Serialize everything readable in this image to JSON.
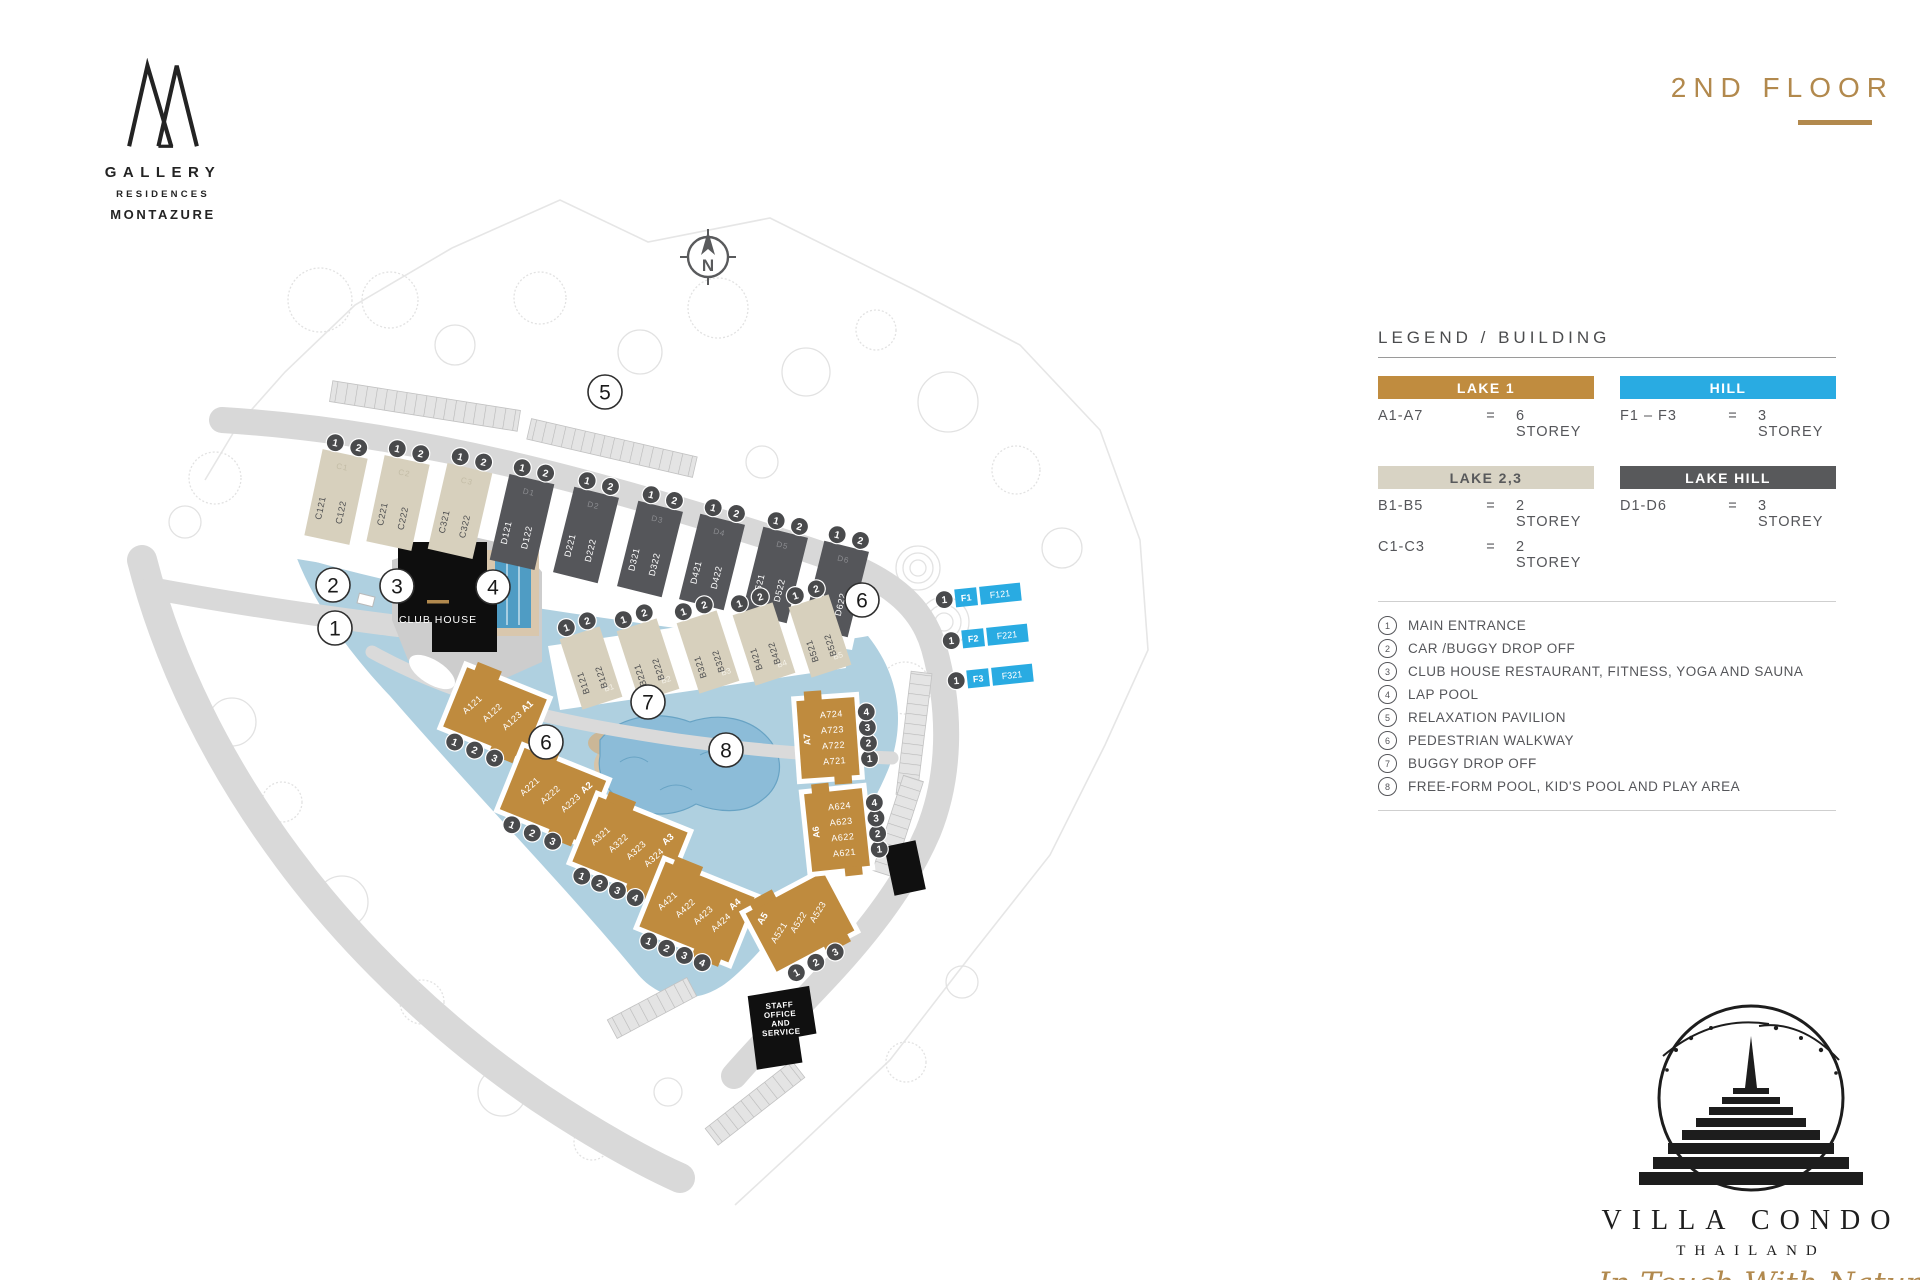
{
  "brand": {
    "gallery": "GALLERY",
    "residences": "RESIDENCES",
    "montazure": "MONTAZURE"
  },
  "header": {
    "floor_title": "2ND FLOOR"
  },
  "legend": {
    "title": "LEGEND / BUILDING",
    "categories": [
      {
        "name": "LAKE 1",
        "color": "#c08c3f",
        "text_color": "#ffffff",
        "rows": [
          {
            "range": "A1-A7",
            "eq": "=",
            "storey": "6 STOREY"
          }
        ]
      },
      {
        "name": "HILL",
        "color": "#29abe2",
        "text_color": "#ffffff",
        "rows": [
          {
            "range": "F1 – F3",
            "eq": "=",
            "storey": "3 STOREY"
          }
        ]
      },
      {
        "name": "LAKE 2,3",
        "color": "#d8d3c4",
        "text_color": "#58595b",
        "rows": [
          {
            "range": "B1-B5",
            "eq": "=",
            "storey": "2 STOREY"
          },
          {
            "range": "C1-C3",
            "eq": "=",
            "storey": "2 STOREY"
          }
        ]
      },
      {
        "name": "LAKE HILL",
        "color": "#58595b",
        "text_color": "#ffffff",
        "rows": [
          {
            "range": "D1-D6",
            "eq": "=",
            "storey": "3 STOREY"
          }
        ]
      }
    ],
    "notes": [
      {
        "num": "1",
        "label": "MAIN ENTRANCE"
      },
      {
        "num": "2",
        "label": "CAR /BUGGY DROP OFF"
      },
      {
        "num": "3",
        "label": "CLUB HOUSE RESTAURANT, FITNESS, YOGA AND SAUNA"
      },
      {
        "num": "4",
        "label": "LAP POOL"
      },
      {
        "num": "5",
        "label": "RELAXATION PAVILION"
      },
      {
        "num": "6",
        "label": "PEDESTRIAN WALKWAY"
      },
      {
        "num": "7",
        "label": "BUGGY DROP OFF"
      },
      {
        "num": "8",
        "label": "FREE-FORM POOL, KID'S POOL AND PLAY AREA"
      }
    ]
  },
  "map": {
    "compass_n": "N",
    "club_house": "CLUB HOUSE",
    "staff_lines": [
      "STAFF",
      "OFFICE",
      "AND",
      "SERVICE"
    ],
    "markers": [
      "1",
      "2",
      "3",
      "4",
      "5",
      "6",
      "6",
      "7",
      "8"
    ],
    "buildings": {
      "cd_row": [
        {
          "label": "C1",
          "units": [
            "C121",
            "C122"
          ],
          "badges": [
            "1",
            "2"
          ]
        },
        {
          "label": "C2",
          "units": [
            "C221",
            "C222"
          ],
          "badges": [
            "1",
            "2"
          ]
        },
        {
          "label": "C3",
          "units": [
            "C321",
            "C322"
          ],
          "badges": [
            "1",
            "2"
          ]
        },
        {
          "label": "D1",
          "units": [
            "D121",
            "D122"
          ],
          "badges": [
            "1",
            "2"
          ]
        },
        {
          "label": "D2",
          "units": [
            "D221",
            "D222"
          ],
          "badges": [
            "1",
            "2"
          ]
        },
        {
          "label": "D3",
          "units": [
            "D321",
            "D322"
          ],
          "badges": [
            "1",
            "2"
          ]
        },
        {
          "label": "D4",
          "units": [
            "D421",
            "D422"
          ],
          "badges": [
            "1",
            "2"
          ]
        },
        {
          "label": "D5",
          "units": [
            "D521",
            "D522"
          ],
          "badges": [
            "1",
            "2"
          ]
        },
        {
          "label": "D6",
          "units": [
            "D621",
            "D622"
          ],
          "badges": [
            "1",
            "2"
          ]
        }
      ],
      "b_row": [
        {
          "label": "B1",
          "units": [
            "B121",
            "B122"
          ],
          "badges": [
            "1",
            "2"
          ]
        },
        {
          "label": "B2",
          "units": [
            "B221",
            "B222"
          ],
          "badges": [
            "1",
            "2"
          ]
        },
        {
          "label": "B3",
          "units": [
            "B321",
            "B322"
          ],
          "badges": [
            "1",
            "2"
          ]
        },
        {
          "label": "B4",
          "units": [
            "B421",
            "B422"
          ],
          "badges": [
            "1",
            "2"
          ]
        },
        {
          "label": "B5",
          "units": [
            "B521",
            "B522"
          ],
          "badges": [
            "1",
            "2"
          ]
        }
      ],
      "a": [
        {
          "label": "A1",
          "units": [
            "A121",
            "A122",
            "A123"
          ],
          "badges": [
            "1",
            "2",
            "3"
          ]
        },
        {
          "label": "A2",
          "units": [
            "A221",
            "A222",
            "A223"
          ],
          "badges": [
            "1",
            "2",
            "3"
          ]
        },
        {
          "label": "A3",
          "units": [
            "A321",
            "A322",
            "A323",
            "A324"
          ],
          "badges": [
            "1",
            "2",
            "3",
            "4"
          ]
        },
        {
          "label": "A4",
          "units": [
            "A421",
            "A422",
            "A423",
            "A424"
          ],
          "badges": [
            "1",
            "2",
            "3",
            "4"
          ]
        },
        {
          "label": "A5",
          "units": [
            "A521",
            "A522",
            "A523"
          ],
          "badges": [
            "1",
            "2",
            "3"
          ]
        },
        {
          "label": "A6",
          "units": [
            "A621",
            "A622",
            "A623",
            "A624"
          ],
          "badges": [
            "1",
            "2",
            "3",
            "4"
          ]
        },
        {
          "label": "A7",
          "units": [
            "A721",
            "A722",
            "A723",
            "A724"
          ],
          "badges": [
            "1",
            "2",
            "3",
            "4"
          ]
        }
      ],
      "f": [
        {
          "label": "F1",
          "unit": "F121",
          "badge": "1"
        },
        {
          "label": "F2",
          "unit": "F221",
          "badge": "1"
        },
        {
          "label": "F3",
          "unit": "F321",
          "badge": "1"
        }
      ]
    },
    "colors": {
      "lake": "#afd0e0",
      "pool": "#4f9cc4",
      "free_form_pool": "#8cbcd8",
      "building_gold": "#bf8b3e",
      "building_beige": "#d7d0bd",
      "building_dark": "#55565a",
      "building_blue": "#29abe2",
      "badge": "#494a4c",
      "road": "#d8d8d8",
      "accent_gold": "#b1894e"
    }
  },
  "footer_logo": {
    "villa": "VILLA CONDO",
    "thailand": "THAILAND",
    "tagline": "In Touch With Nature"
  }
}
